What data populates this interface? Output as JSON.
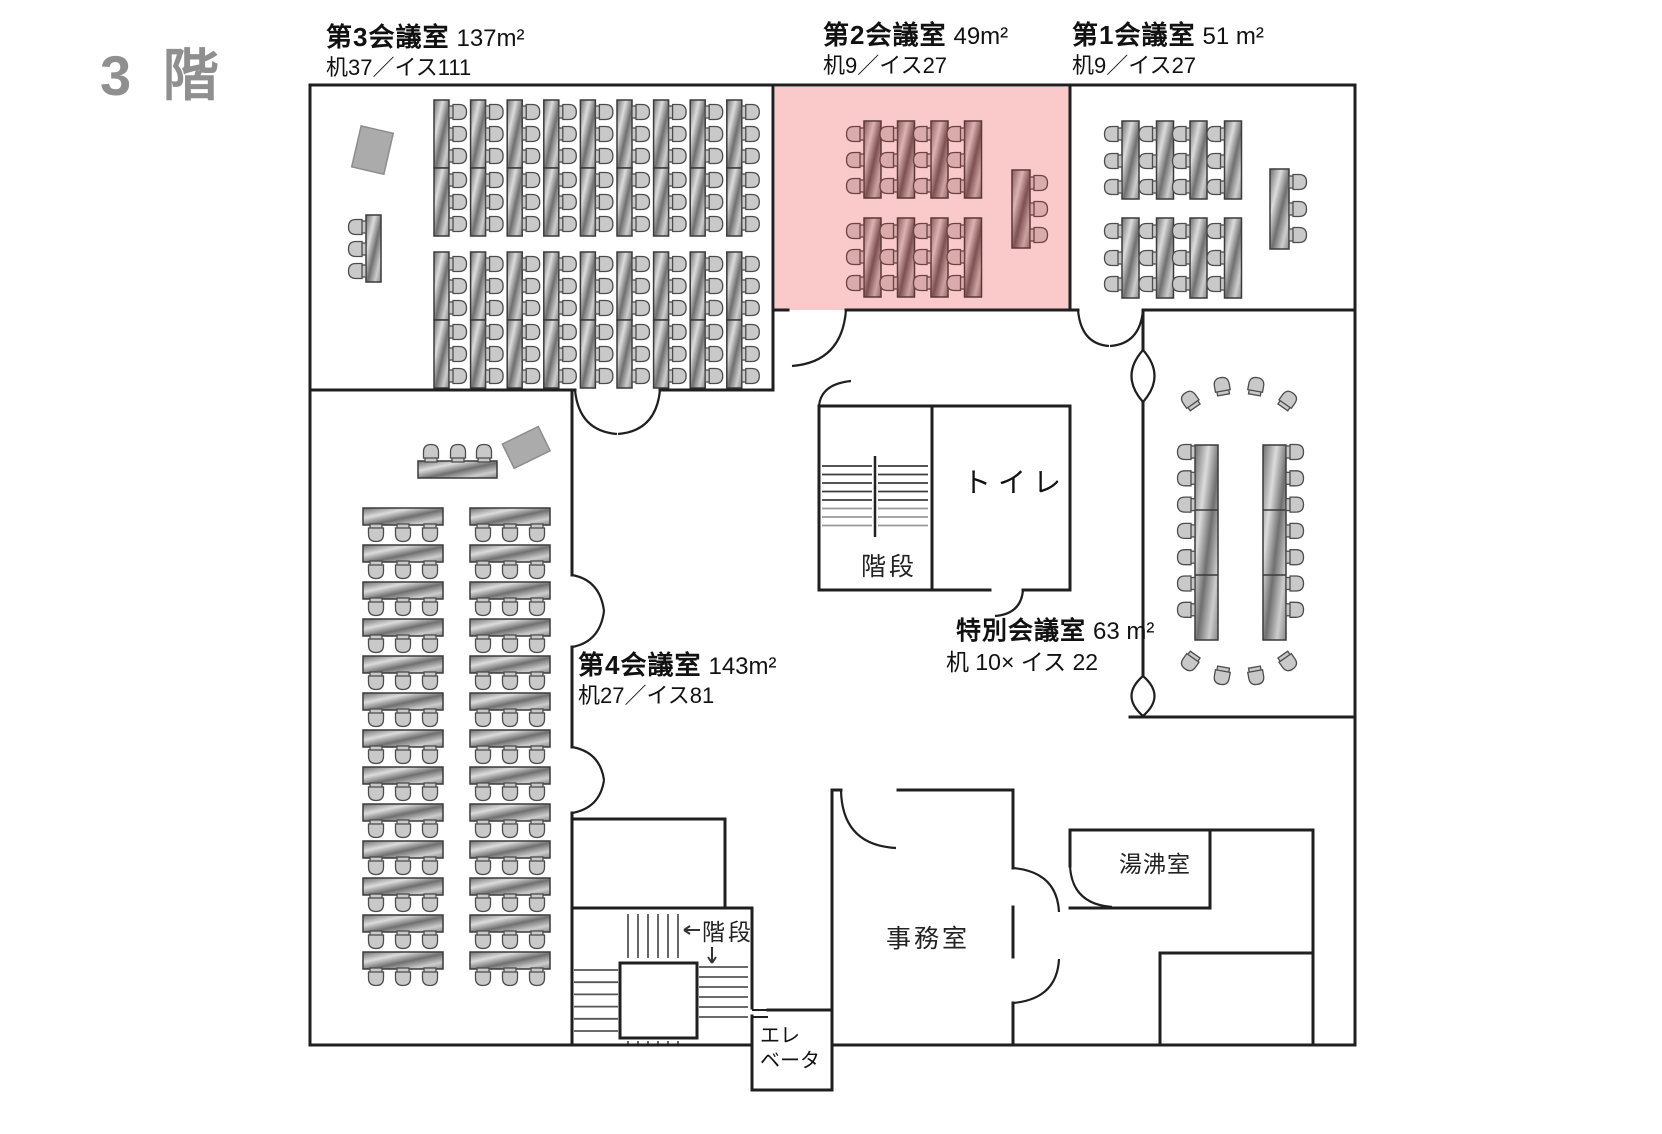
{
  "floor_title": "3 階",
  "rooms": {
    "room3": {
      "name": "第3会議室",
      "area": "137m²",
      "capacity": "机37／イス111"
    },
    "room2": {
      "name": "第2会議室",
      "area": "49m²",
      "capacity": "机9／イス27"
    },
    "room1": {
      "name": "第1会議室",
      "area": "51 m²",
      "capacity": "机9／イス27"
    },
    "room4": {
      "name": "第4会議室",
      "area": "143m²",
      "capacity": "机27／イス81"
    },
    "special": {
      "name": "特別会議室",
      "area": "63 m²",
      "capacity": "机 10× イス 22"
    },
    "toilet": {
      "label": "トイレ"
    },
    "stairs_top": {
      "label": "階段"
    },
    "stairs_bottom": {
      "label": "階段"
    },
    "elevator": {
      "label": "エレベータ",
      "line1": "エレ",
      "line2": "ベータ"
    },
    "office": {
      "label": "事務室"
    },
    "kitchenette": {
      "label": "湯沸室"
    }
  },
  "colors": {
    "highlight_room": "#fac9c9",
    "wall": "#1f1f1f",
    "table_gray": "#9a9a9a",
    "table_pink": "#a87878",
    "title_gray": "#8f8f8f"
  }
}
